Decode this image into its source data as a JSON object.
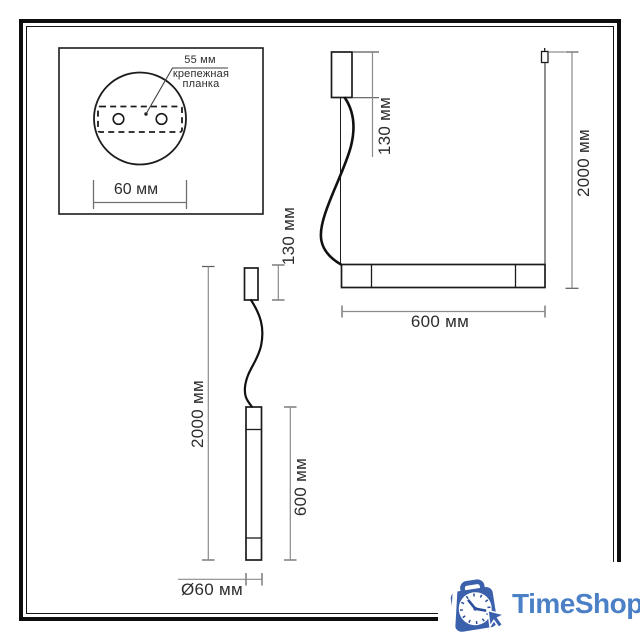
{
  "drawing": {
    "plate_view": {
      "dim_hole_spacing": "55 мм",
      "label_line1": "крепежная",
      "label_line2": "планка",
      "dim_base_width": "60 мм"
    },
    "bar_lamp": {
      "dim_canopy_height": "130 мм",
      "dim_overall_height": "2000 мм",
      "dim_width": "600 мм"
    },
    "pendant_lamp": {
      "dim_canopy_height": "130 мм",
      "dim_overall_height": "2000 мм",
      "dim_tube_length": "600 мм",
      "dim_diameter": "Ø60 мм"
    }
  },
  "watermark": {
    "brand": "TimeShop",
    "icon": "alarm-clock-shopping-bag-icon",
    "colors": {
      "text": "#4b80c6",
      "bag": "#3b61ad",
      "clock_marks": "#2b4d9b"
    }
  },
  "colors": {
    "outline": "#1c1c1c",
    "dimension_line": "#8a8a8a",
    "tick": "#5a5a5a",
    "frame": "#0e0e0e",
    "label_text": "#2d2d2d"
  }
}
